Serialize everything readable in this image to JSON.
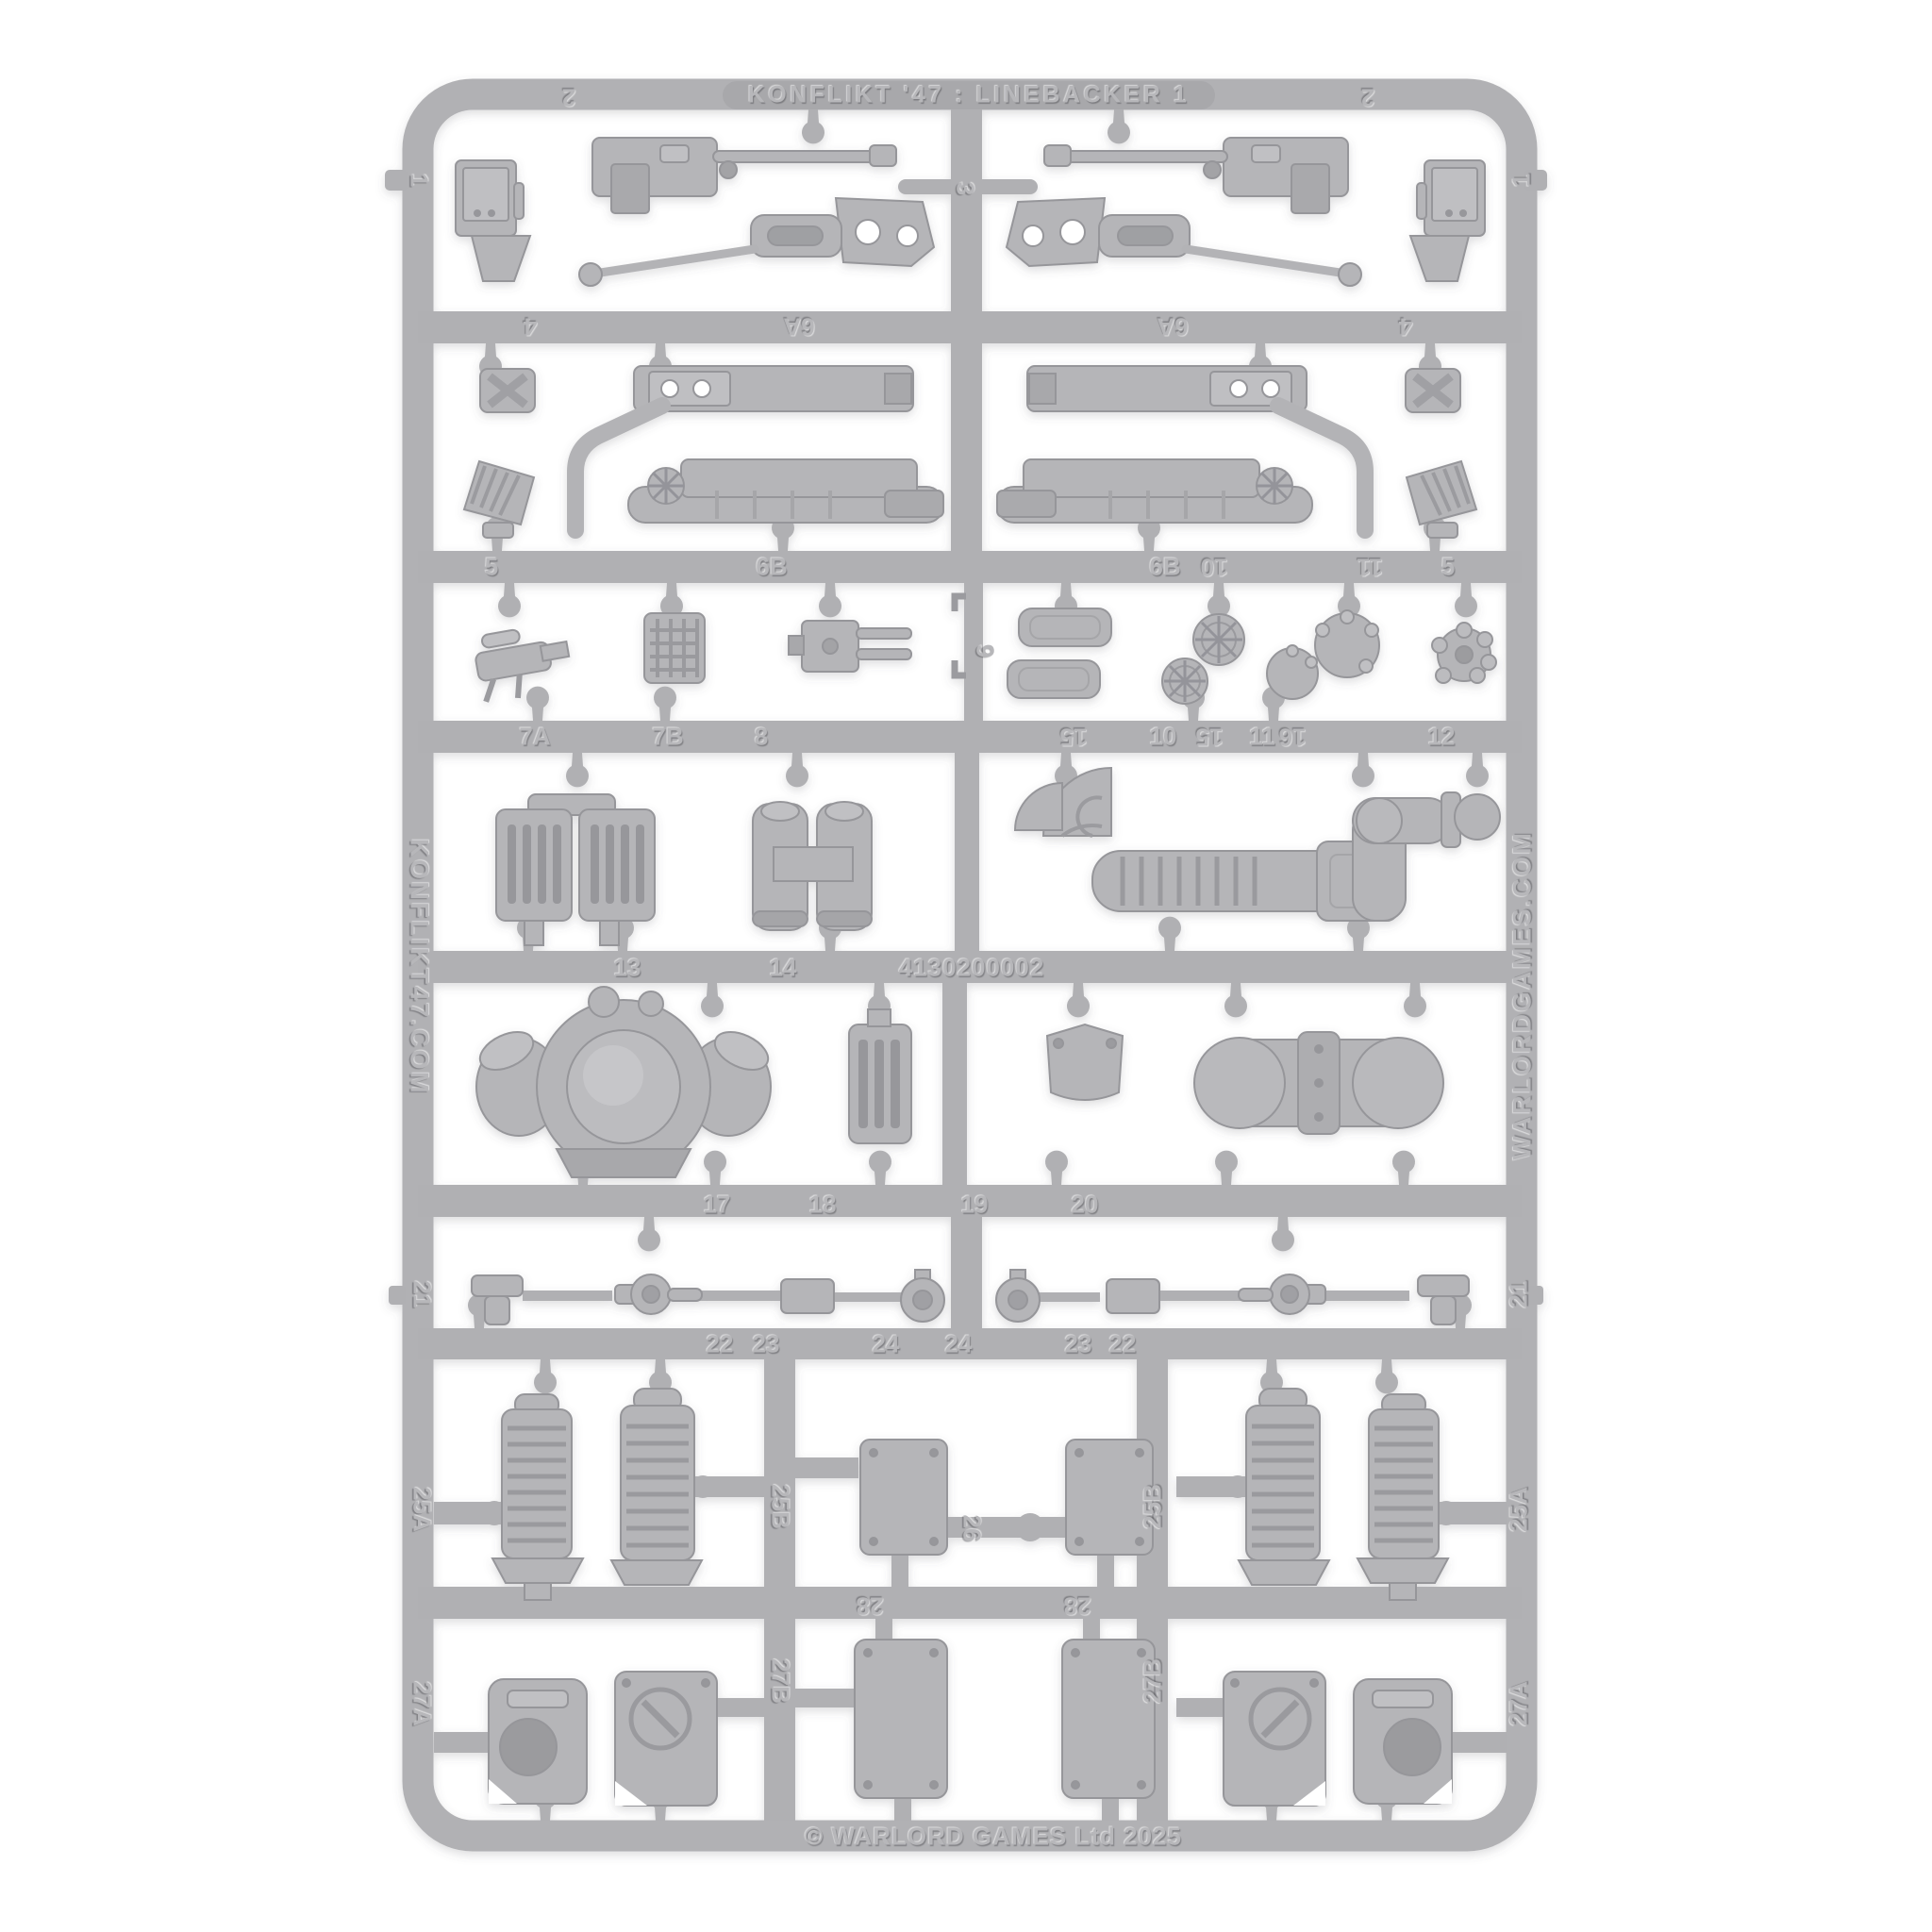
{
  "photo": {
    "background_color": "#ffffff",
    "plastic_color": "#b1b1b4",
    "subject": "gray plastic model kit sprue photographed on white"
  },
  "sprue": {
    "title": "KONFLIKT '47 : LINEBACKER 1",
    "left_rail_text": "KONFLIKT47.COM",
    "right_rail_text": "WARLORDGAMES.COM",
    "product_code": "4130200002",
    "copyright": "© WARLORD GAMES Ltd 2025",
    "part_numbers": [
      "2",
      "3",
      "2",
      "1",
      "1",
      "4",
      "6A",
      "6A",
      "4",
      "5",
      "6B",
      "6B",
      "10",
      "11",
      "5",
      "7A",
      "7B",
      "8",
      "9",
      "15",
      "10",
      "15",
      "11",
      "16",
      "12",
      "13",
      "14",
      "17",
      "18",
      "19",
      "20",
      "21",
      "21",
      "22",
      "23",
      "24",
      "24",
      "23",
      "22",
      "25A",
      "25B",
      "26",
      "25B",
      "25A",
      "28",
      "28",
      "27A",
      "27B",
      "27B",
      "27A"
    ]
  }
}
